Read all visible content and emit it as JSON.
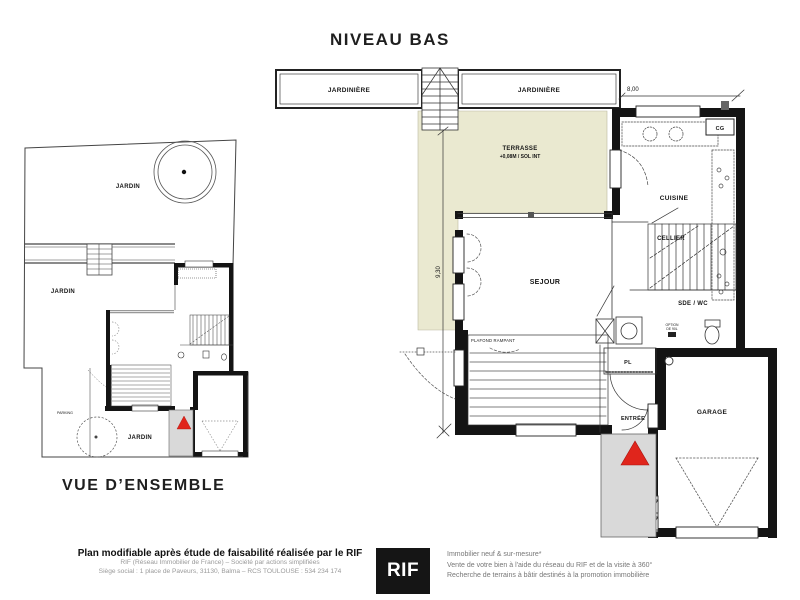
{
  "page": {
    "niveau_bas_title": "NIVEAU BAS",
    "overview_title": "VUE D’ENSEMBLE"
  },
  "plan": {
    "jardiniere_left": "JARDINIÈRE",
    "jardiniere_right": "JARDINIÈRE",
    "dim_width": "8,00",
    "dim_height": "9,30",
    "terrasse": "TERRASSE",
    "terrasse_note": "+0,08M / SOL INT",
    "sejour": "SEJOUR",
    "cuisine": "CUISINE",
    "cellier": "CELLIER",
    "cg": "CG",
    "sde_wc": "SDE / WC",
    "pl": "PL",
    "entree": "ENTRÉE",
    "garage": "GARAGE",
    "plafond_rampant": "PLAFOND RAMPANT",
    "option_line1": "OPTION",
    "option_line2": "DE 90L"
  },
  "overview": {
    "jardin_top": "JARDIN",
    "jardin_left": "JARDIN",
    "jardin_bottom": "JARDIN",
    "parking": "PARKING"
  },
  "footer": {
    "bold_line": "Plan modifiable après étude de faisabilité réalisée par le RIF",
    "sub_line1": "RIF (Réseau Immobilier de France) – Société par actions simplifiées",
    "sub_line2": "Siège social : 1 place de Paveurs, 31130, Balma – RCS TOULOUSE : 534 234 174",
    "logo_text": "RIF",
    "right_line1": "Immobilier neuf & sur-mesure*",
    "right_line2": "Vente de votre bien à l'aide du réseau du RIF et de la visite à 360°",
    "right_line3": "Recherche de terrains à bâtir destinés à la promotion immobilière"
  },
  "colors": {
    "terrace": "#eae9d0",
    "porch": "#d9d9d9",
    "arrow_red": "#e0251c",
    "wall": "#141414"
  }
}
